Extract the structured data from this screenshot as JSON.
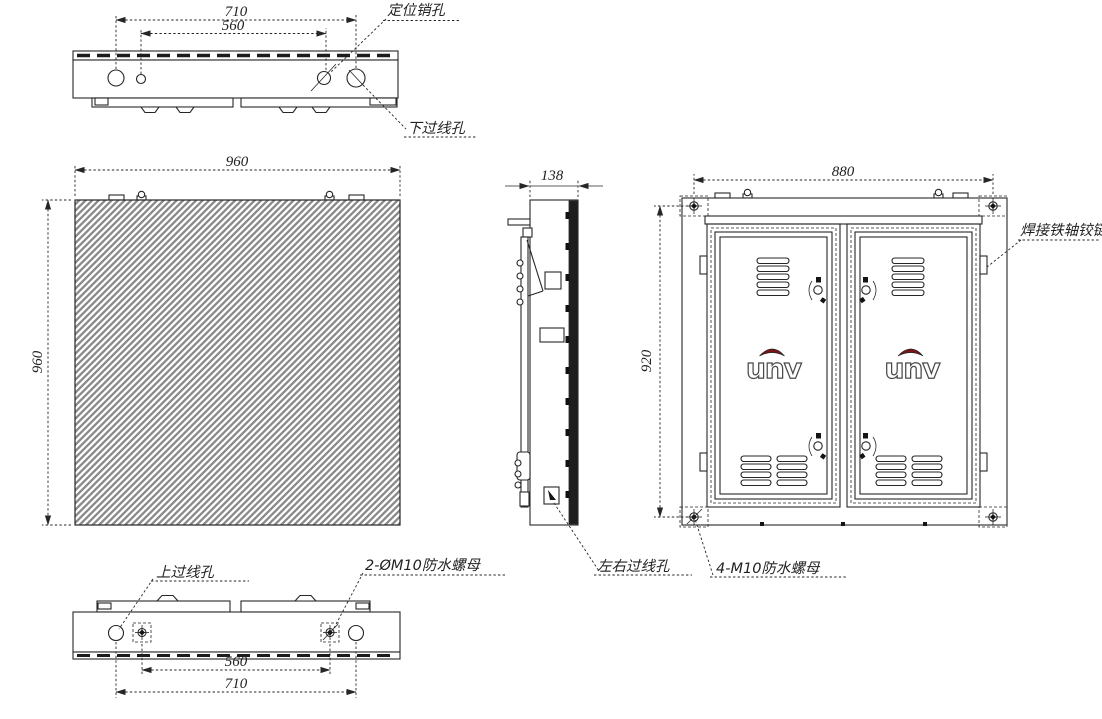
{
  "views": {
    "top": {
      "dims": {
        "outer": "710",
        "inner": "560"
      },
      "labels": {
        "positioning_pin_hole": "定位销孔",
        "lower_cable_hole": "下过线孔"
      }
    },
    "front": {
      "dims": {
        "width": "960",
        "height": "960"
      }
    },
    "side": {
      "dims": {
        "depth": "138"
      },
      "labels": {
        "side_cable_hole": "左右过线孔"
      }
    },
    "back": {
      "dims": {
        "width": "880",
        "height": "920"
      },
      "labels": {
        "welded_hinge": "焊接铁轴铰链",
        "waterproof_nuts": "4-M10防水螺母"
      },
      "logo": "unv"
    },
    "bottom": {
      "dims": {
        "inner": "560",
        "outer": "710"
      },
      "labels": {
        "upper_cable_hole": "上过线孔",
        "waterproof_nuts": "2-ØM10防水螺母"
      }
    }
  },
  "colors": {
    "line": "#262626",
    "hatch": "#8a8a8a",
    "logo_red": "#7a1517",
    "background": "#ffffff"
  }
}
